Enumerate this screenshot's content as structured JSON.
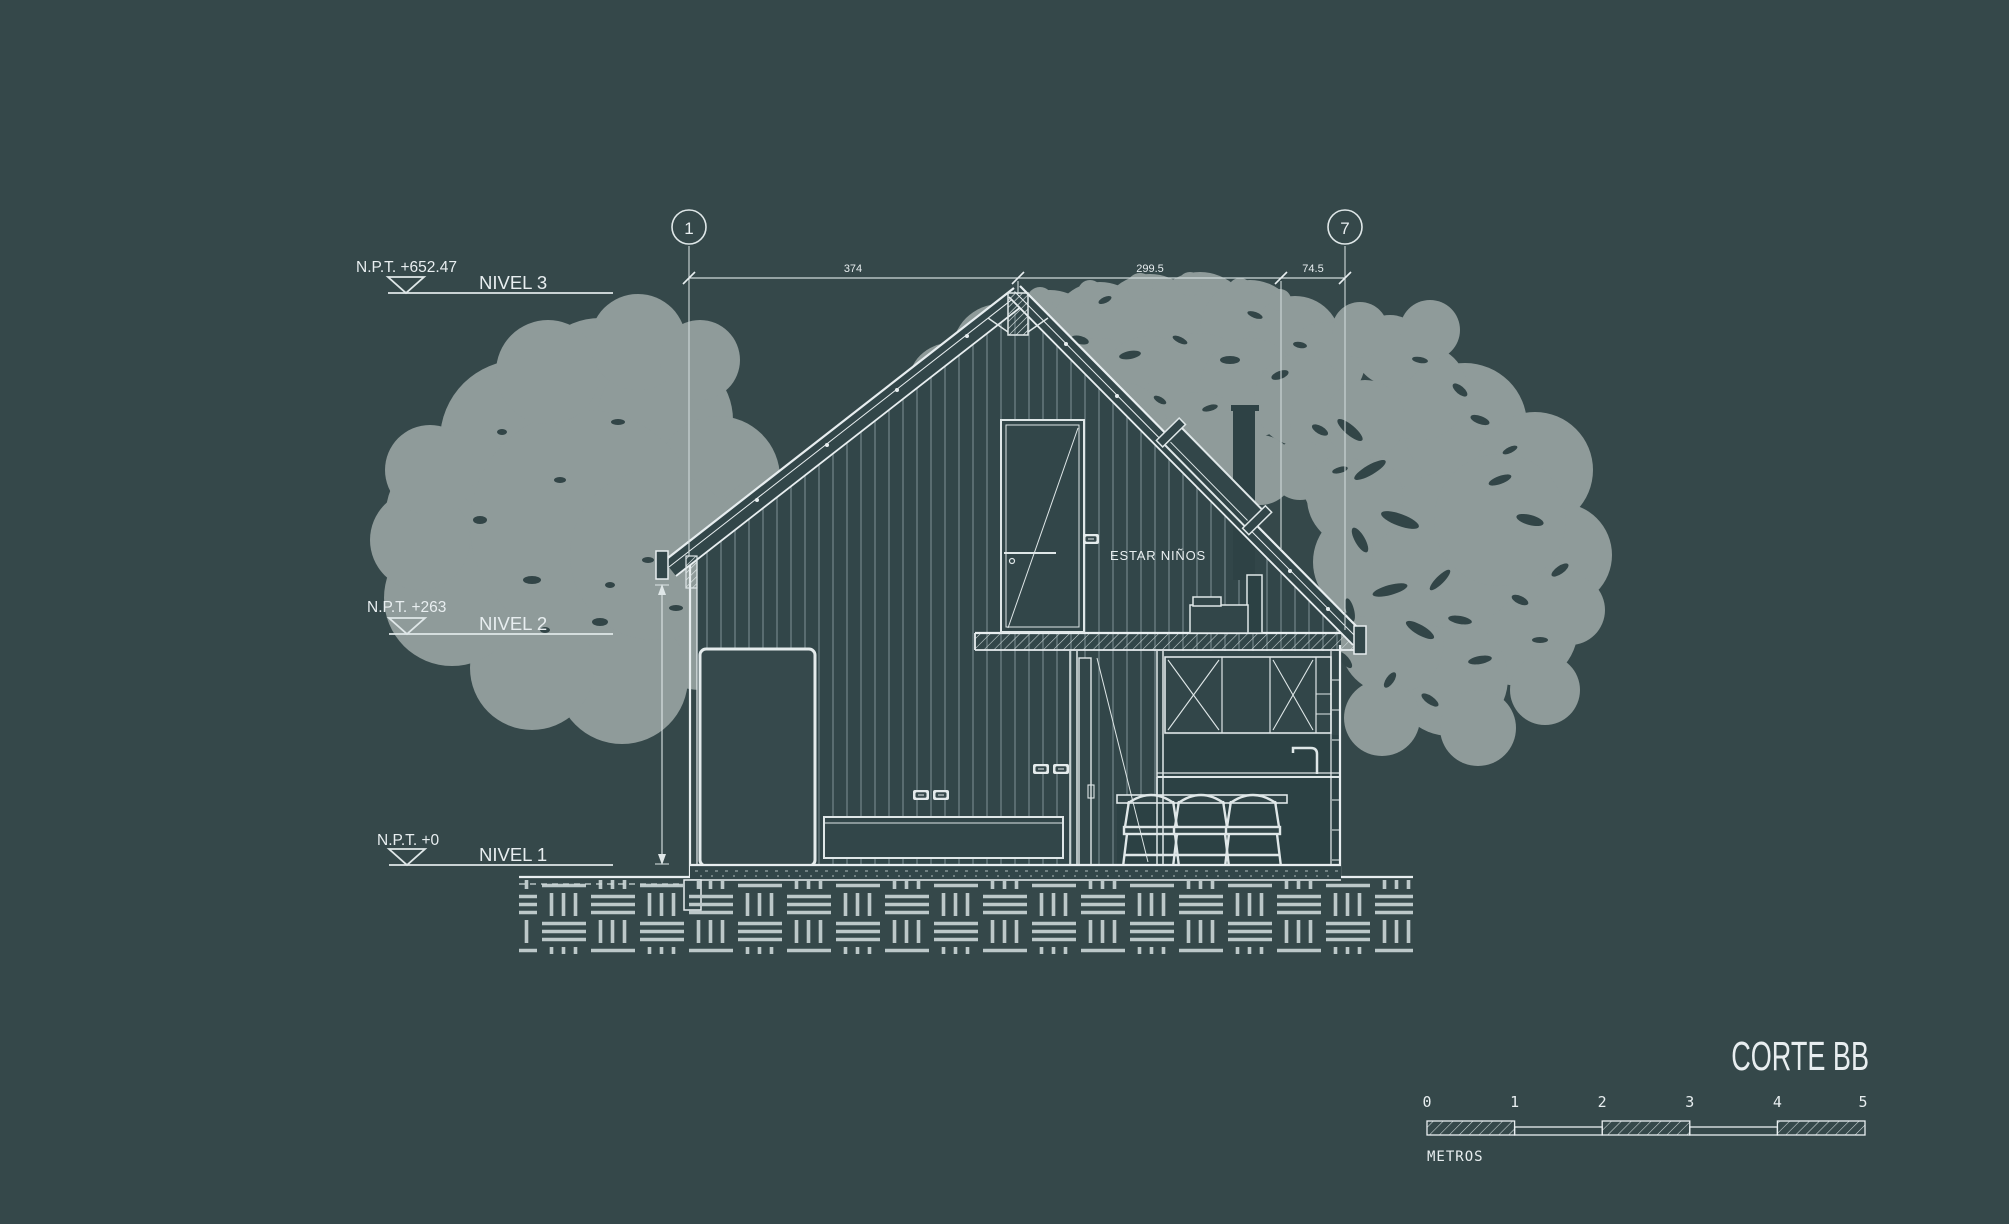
{
  "drawing": {
    "title": "CORTE BB",
    "room_label": "ESTAR NIÑOS"
  },
  "grid_bubbles": [
    {
      "label": "1"
    },
    {
      "label": "7"
    }
  ],
  "top_dimensions": [
    {
      "value": "374"
    },
    {
      "value": "299.5"
    },
    {
      "value": "74.5"
    }
  ],
  "levels": [
    {
      "npt": "N.P.T. +652.47",
      "name": "NIVEL 3"
    },
    {
      "npt": "N.P.T. +263",
      "name": "NIVEL 2"
    },
    {
      "npt": "N.P.T. +0",
      "name": "NIVEL 1"
    }
  ],
  "scale_bar": {
    "ticks": [
      "0",
      "1",
      "2",
      "3",
      "4",
      "5"
    ],
    "unit": "METROS"
  },
  "colors": {
    "background": "#35484a",
    "ink": "#e8eef0",
    "ink_dim": "#c9d4d5",
    "tree": "#8f9b9a",
    "tree_speckle": "#324547",
    "interior": "#324649",
    "panel_dark": "#2c4144",
    "siding_line": "#6e8184"
  }
}
